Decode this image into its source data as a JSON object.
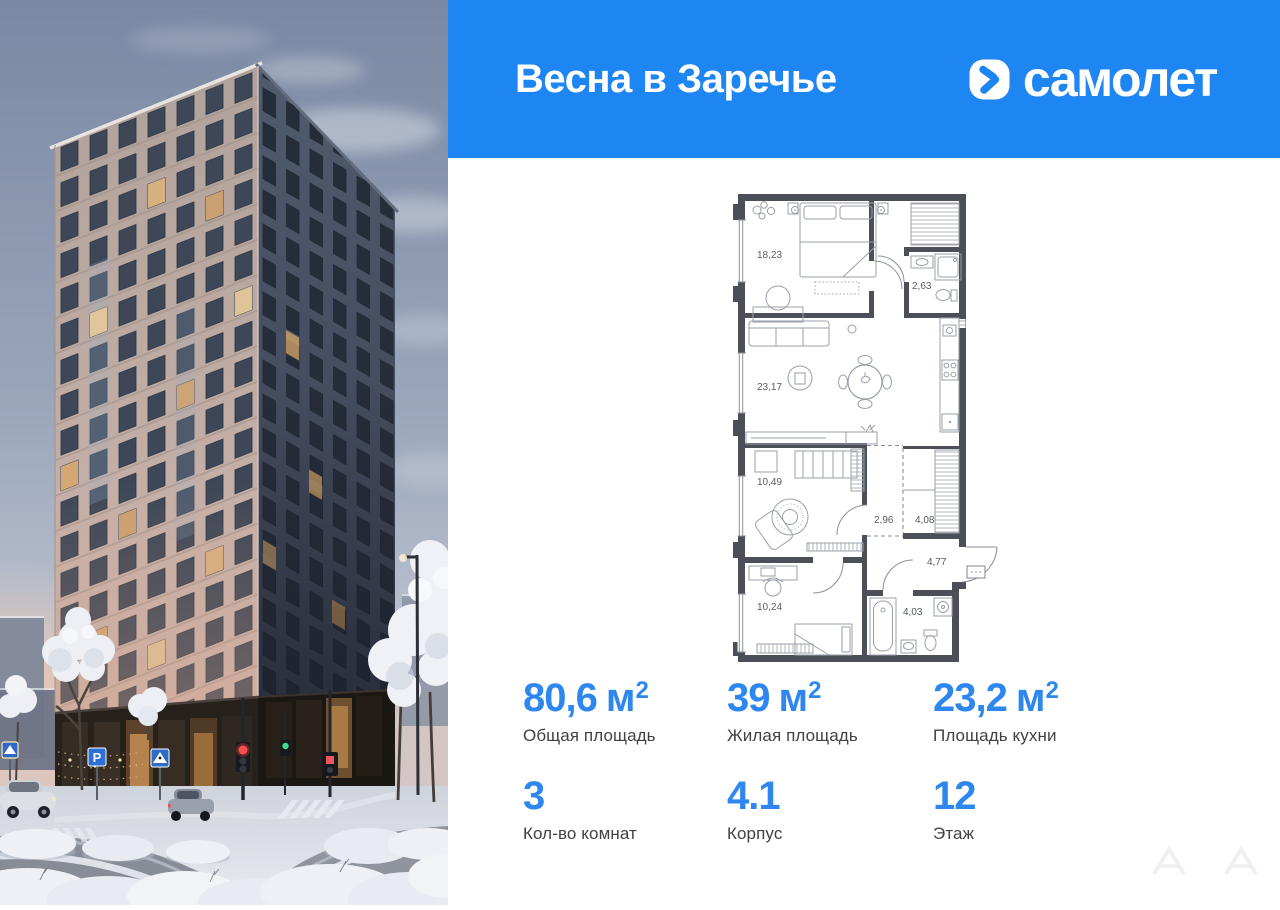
{
  "header": {
    "project_title": "Весна в Заречье",
    "brand_name": "самолет"
  },
  "photo": {
    "description": "winter-evening-render-of-residential-tower",
    "parking_sign_label": "P"
  },
  "plan": {
    "rooms": [
      {
        "name": "bedroom-main",
        "area": "18,23"
      },
      {
        "name": "bathroom-top",
        "area": "2,63"
      },
      {
        "name": "kitchen-living-room",
        "area": "23,17"
      },
      {
        "name": "bedroom-2",
        "area": "10,49"
      },
      {
        "name": "corridor",
        "area": "2,96"
      },
      {
        "name": "wardrobe",
        "area": "4,08"
      },
      {
        "name": "hall",
        "area": "4,77"
      },
      {
        "name": "bedroom-3",
        "area": "10,24"
      },
      {
        "name": "bathroom-2",
        "area": "4,03"
      }
    ]
  },
  "stats": {
    "areas": [
      {
        "value": "80,6",
        "unit": "м",
        "sup": "2",
        "label": "Общая площадь"
      },
      {
        "value": "39",
        "unit": "м",
        "sup": "2",
        "label": "Жилая площадь"
      },
      {
        "value": "23,2",
        "unit": "м",
        "sup": "2",
        "label": "Площадь кухни"
      }
    ],
    "details": [
      {
        "value": "3",
        "label": "Кол-во комнат"
      },
      {
        "value": "4.1",
        "label": "Корпус"
      },
      {
        "value": "12",
        "label": "Этаж"
      }
    ]
  },
  "colors": {
    "brand_blue": "#1d86f2",
    "stat_number_blue": "#2e87f0",
    "plan_wall_gray": "#4c4f58",
    "sky_top": "#7a88a3",
    "facade_beige": "#c0aca3",
    "facade_dark_side": "#454e60"
  }
}
